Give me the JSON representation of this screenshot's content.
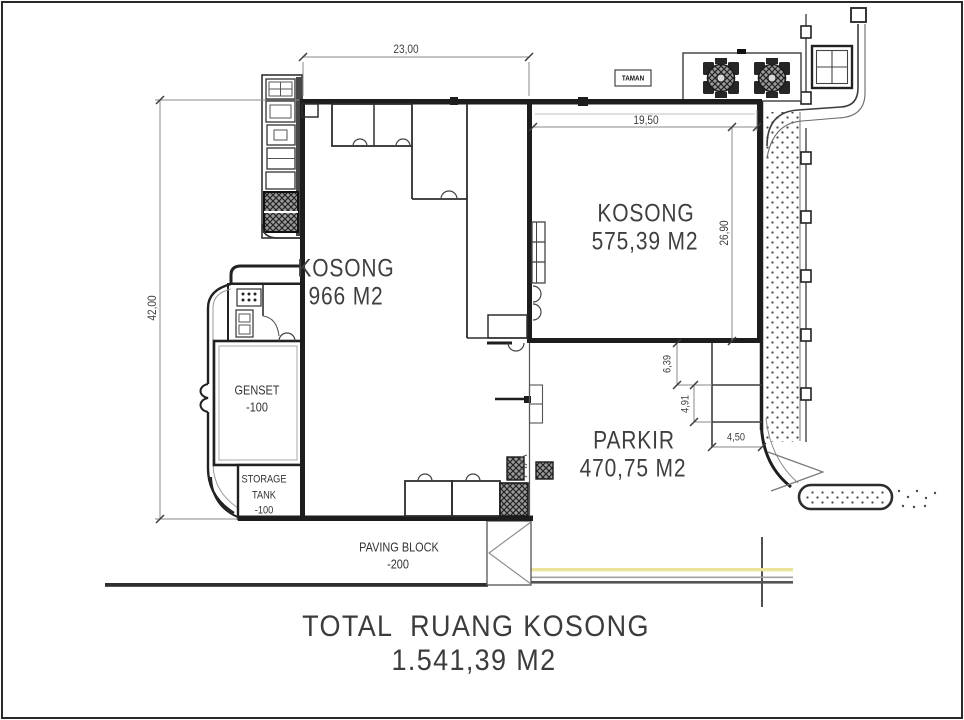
{
  "rooms": {
    "kosong_main": {
      "name": "KOSONG",
      "area": "966 M2"
    },
    "kosong_right": {
      "name": "KOSONG",
      "area": "575,39 M2"
    },
    "parkir": {
      "name": "PARKIR",
      "area": "470,75 M2"
    },
    "genset": {
      "name": "GENSET",
      "level": "-100"
    },
    "storage_tank": {
      "line1": "STORAGE",
      "line2": "TANK",
      "line3": "-100"
    },
    "paving_block": {
      "name": "PAVING BLOCK",
      "level": "-200"
    },
    "taman": {
      "name": "TAMAN"
    }
  },
  "dimensions": {
    "top_width": "23,00",
    "left_height": "42,00",
    "kosong_right_width": "19,50",
    "kosong_right_height": "26,90",
    "parkir_step_1": "6,39",
    "parkir_step_2": "4,91",
    "parkir_step_3": "4,50"
  },
  "summary": {
    "title": "TOTAL  RUANG KOSONG",
    "value": "1.541,39 M2"
  },
  "colors": {
    "wall": "#1d1d1d",
    "line": "#3c3c3c",
    "road_yellow": "#e9e49a"
  }
}
